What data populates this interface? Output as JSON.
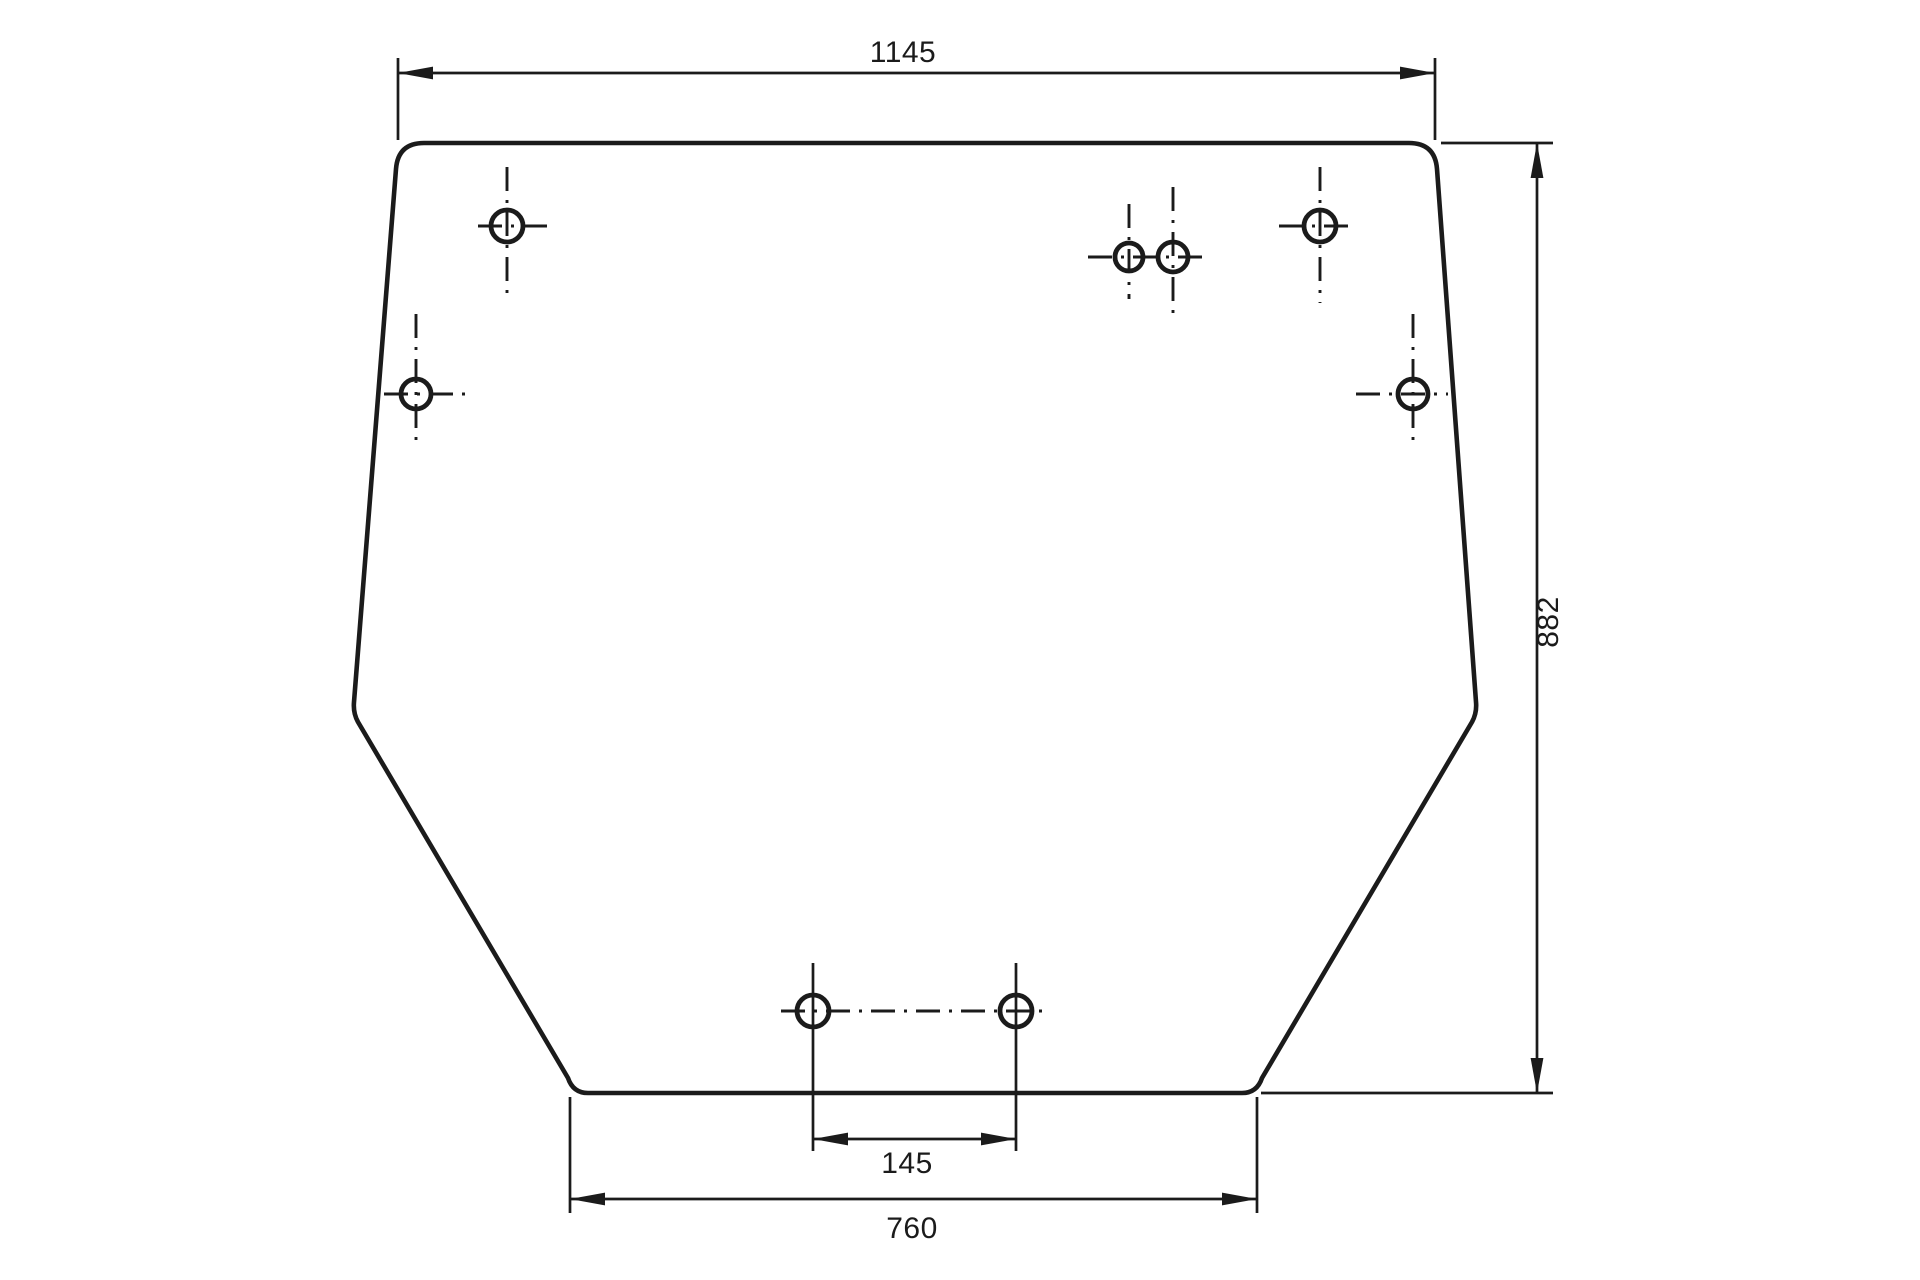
{
  "drawing": {
    "kind": "panel-outline-technical-drawing",
    "colors": {
      "line": "#1b1b1b",
      "background": "#ffffff"
    },
    "dimensions": {
      "top_width": "1145",
      "right_height": "882",
      "bottom_hole_spacing": "145",
      "bottom_width": "760"
    },
    "holes_count": 8
  }
}
